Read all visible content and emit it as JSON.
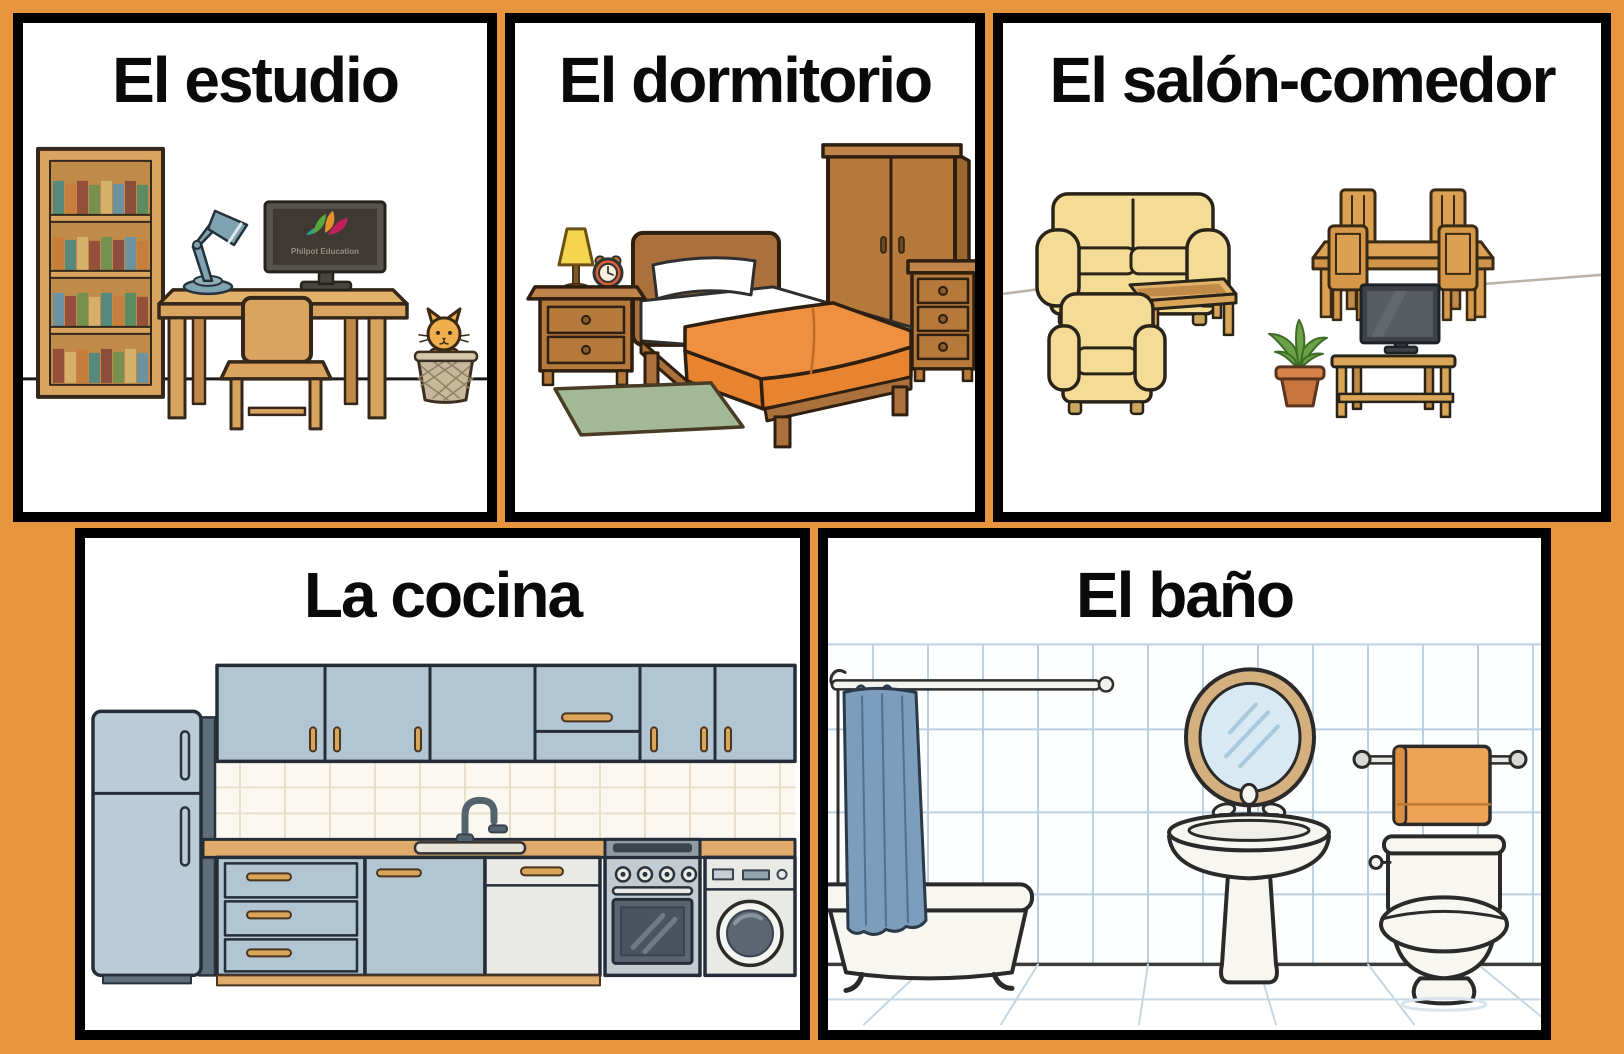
{
  "poster": {
    "background_color": "#E8953F",
    "panel_border_color": "#000000",
    "panel_background_color": "#FFFFFF",
    "title_color": "#0A0A0A"
  },
  "panels": [
    {
      "id": "estudio",
      "title": "El estudio",
      "objects": [
        "bookshelf",
        "desk-lamp",
        "computer-monitor",
        "desk",
        "chair",
        "cat-in-wastebasket"
      ]
    },
    {
      "id": "dormitorio",
      "title": "El dormitorio",
      "objects": [
        "table-lamp",
        "alarm-clock",
        "nightstand",
        "bed",
        "pillow",
        "orange-blanket",
        "wardrobe",
        "chest-of-drawers",
        "green-rug"
      ]
    },
    {
      "id": "salon_comedor",
      "title": "El salón-comedor",
      "objects": [
        "sofa",
        "armchair",
        "coffee-table",
        "dining-table",
        "dining-chairs",
        "potted-plant",
        "television",
        "tv-stand"
      ]
    },
    {
      "id": "cocina",
      "title": "La cocina",
      "objects": [
        "refrigerator",
        "wall-cabinets",
        "tiled-backsplash",
        "counter",
        "sink-and-faucet",
        "drawer-unit",
        "dishwasher",
        "oven-stove",
        "washing-machine"
      ]
    },
    {
      "id": "bano",
      "title": "El baño",
      "objects": [
        "shower-rod",
        "shower-curtain",
        "bathtub",
        "oval-mirror",
        "pedestal-sink",
        "towel-rail",
        "toilet",
        "tiled-wall"
      ]
    }
  ],
  "monitor_watermark": "Philpot Education",
  "palette": {
    "wood_light": "#D9A45F",
    "wood_brown": "#B5793C",
    "sofa_yellow": "#F5DC96",
    "blanket_orange": "#EF9040",
    "cabinet_blue": "#B2C5D2",
    "tile_blue": "#BCD0E2",
    "curtain_blue": "#7C9EBC",
    "towel_orange": "#EDA457",
    "rug_green": "#A3B894",
    "cat_orange": "#F0AF4E"
  }
}
